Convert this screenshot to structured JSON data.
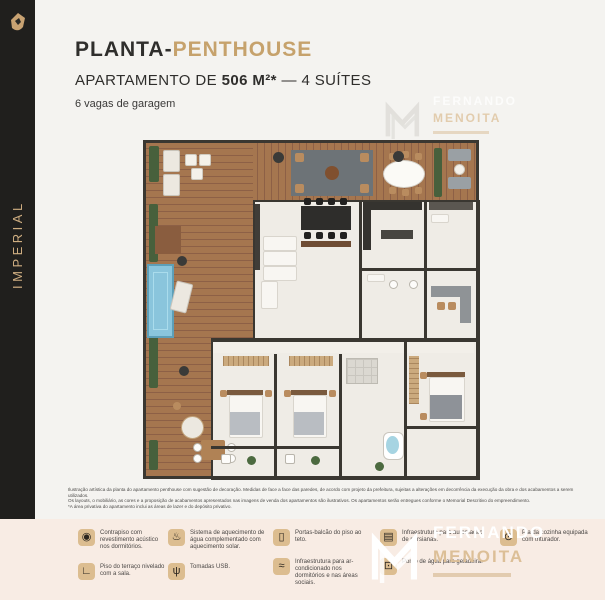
{
  "brand": {
    "name": "IMPERIAL",
    "logo": "crest-icon"
  },
  "header": {
    "title_prefix": "PLANTA-",
    "title_highlight": "PENTHOUSE",
    "subtitle_pre": "APARTAMENTO DE ",
    "subtitle_bold": "506 M²*",
    "subtitle_post": " — 4 SUÍTES",
    "garage": "6 vagas de garagem"
  },
  "disclaimer": {
    "line1": "Ilustração artística da planta do apartamento penthouse com sugestão de decoração. Medidas de face a face das paredes, de acordo com projeto da prefeitura, sujeitas a alterações em decorrência da execução da obra e dos acabamentos a serem utilizados.",
    "line2": "Os layouts, o mobiliário, as cores e a proposição de acabamentos apresentados nas imagens de venda dos apartamentos são ilustrativos. Os apartamentos serão entregues conforme o Memorial Descritivo do empreendimento.",
    "line3": "*A área privativa do apartamento inclui as áreas de lazer e do depósito privativo."
  },
  "features": [
    {
      "icon": "acoustic-floor-icon",
      "glyph": "◉",
      "text": "Contrapiso com revestimento acústico nos dormitórios."
    },
    {
      "icon": "level-floor-icon",
      "glyph": "∟",
      "text": "Piso do terraço nivelado com a sala."
    },
    {
      "icon": "solar-water-heating-icon",
      "glyph": "♨",
      "text": "Sistema de aquecimento de água complementado com aquecimento solar."
    },
    {
      "icon": "usb-outlet-icon",
      "glyph": "ψ",
      "text": "Tomadas USB."
    },
    {
      "icon": "floor-to-ceiling-door-icon",
      "glyph": "▯",
      "text": "Portas-balcão do piso ao teto."
    },
    {
      "icon": "air-conditioning-icon",
      "glyph": "≈",
      "text": "Infraestrutura para ar-condicionado nos dormitórios e nas áreas sociais."
    },
    {
      "icon": "blinds-automation-icon",
      "glyph": "▤",
      "text": "Infraestrutura para automação de persianas."
    },
    {
      "icon": "fridge-water-point-icon",
      "glyph": "⊡",
      "text": "Ponto de água para geladeira."
    },
    {
      "icon": "sink-disposal-icon",
      "glyph": "⊙",
      "text": "Pia da cozinha equipada com triturador."
    }
  ],
  "watermark": {
    "line1": "FERNANDO",
    "line2": "MENOITA"
  },
  "palette": {
    "sidebar_bg": "#201f1d",
    "page_bg": "#f4f3f0",
    "footer_bg": "#f8ece4",
    "accent_gold": "#c6a26c",
    "icon_tile": "#dcbd90",
    "title_dark": "#2f2e2c",
    "plan_wood": "#9e6f4d",
    "plan_floor": "#efece6",
    "plan_wall": "#3a3731",
    "pool_blue": "#8ac5dc",
    "plant_green": "#47603c"
  }
}
